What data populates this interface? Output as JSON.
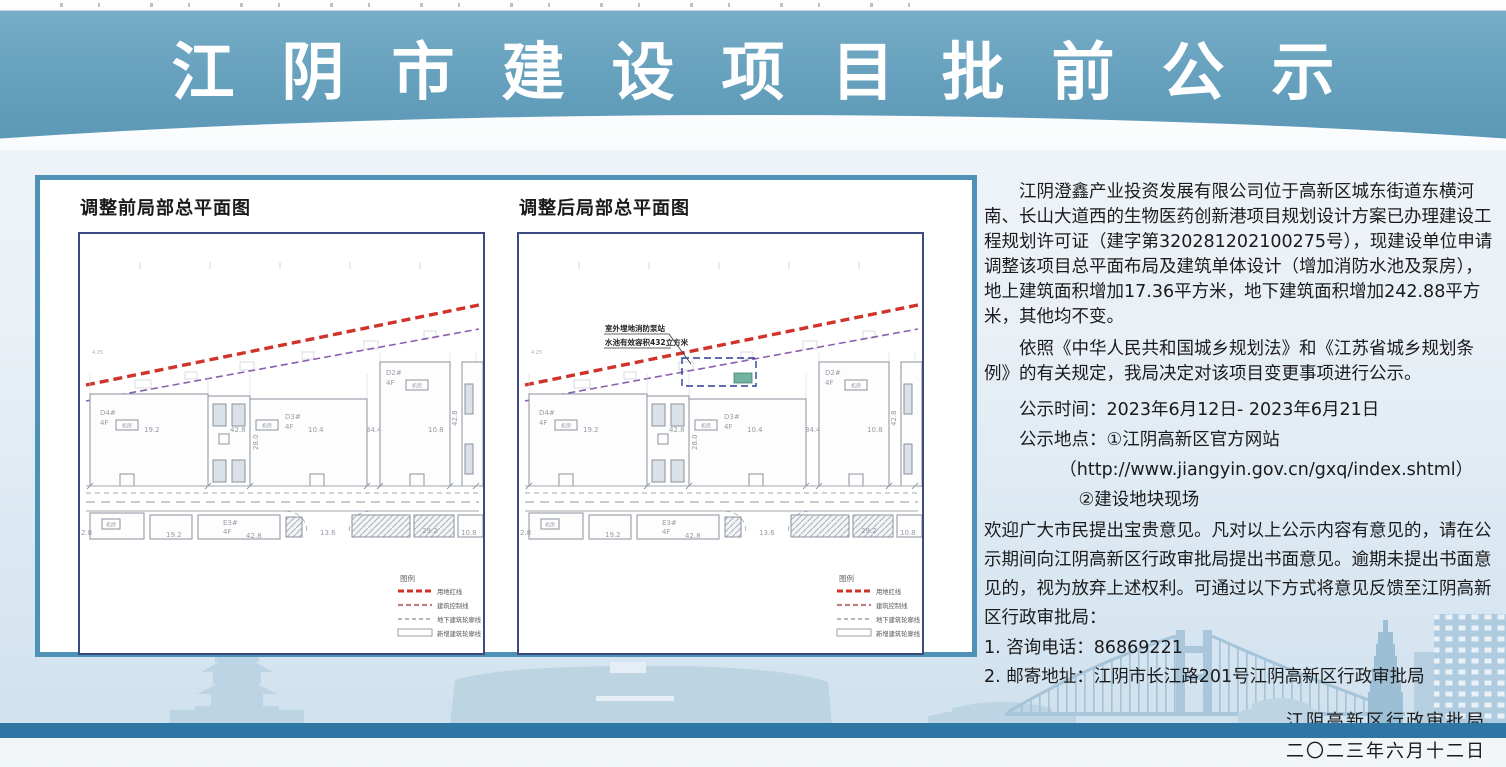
{
  "header": {
    "title": "江阴市建设项目批前公示"
  },
  "plans": {
    "before": {
      "title": "调整前局部总平面图"
    },
    "after": {
      "title": "调整后局部总平面图"
    }
  },
  "plan": {
    "misc_label": "4.25",
    "room_label": "机房",
    "buildings": {
      "d4": {
        "label": "D4#",
        "floors": "4F"
      },
      "d3": {
        "label": "D3#",
        "floors": "4F"
      },
      "d2": {
        "label": "D2#",
        "floors": "4F"
      },
      "e3": {
        "label": "E3#",
        "floors": "4F"
      }
    },
    "dims": {
      "w1": "19.2",
      "w2": "42.8",
      "w3": "10.4",
      "w4": "34.4",
      "w5": "10.8",
      "h1": "28.0",
      "h2": "42.8",
      "b1": "2.8",
      "b2": "19.2",
      "b3": "42.8",
      "b4": "13.6",
      "b5": "29.2",
      "b6": "10.8"
    },
    "legend": {
      "title": "图例",
      "items": [
        "用地红线",
        "建筑控制线",
        "地下建筑轮廓线",
        "新增建筑轮廓线"
      ]
    },
    "annotation": {
      "line1": "室外埋地消防泵站",
      "line2": "水池有效容积432立方米"
    }
  },
  "notice": {
    "p1": "江阴澄鑫产业投资发展有限公司位于高新区城东街道东横河南、长山大道西的生物医药创新港项目规划设计方案已办理建设工程规划许可证（建字第320281202100275号），现建设单位申请调整该项目总平面布局及建筑单体设计（增加消防水池及泵房），地上建筑面积增加17.36平方米，地下建筑面积增加242.88平方米，其他均不变。",
    "p2": "依照《中华人民共和国城乡规划法》和《江苏省城乡规划条例》的有关规定，我局决定对该项目变更事项进行公示。",
    "time_line": "公示时间：2023年6月12日- 2023年6月21日",
    "place_line": "公示地点：①江阴高新区官方网站",
    "url_line": "（http://www.jiangyin.gov.cn/gxq/index.shtml）",
    "place2_line": "②建设地块现场",
    "p3": "欢迎广大市民提出宝贵意见。凡对以上公示内容有意见的，请在公示期间向江阴高新区行政审批局提出书面意见。逾期未提出书面意见的，视为放弃上述权利。可通过以下方式将意见反馈至江阴高新区行政审批局：",
    "item1": "1. 咨询电话：86869221",
    "item2": "2. 邮寄地址：江阴市长江路201号江阴高新区行政审批局",
    "signature": "江阴高新区行政审批局",
    "date": "二〇二三年六月十二日"
  },
  "colors": {
    "header_bg": "#649fbc",
    "bottom_band": "#2e76a3",
    "panel_border": "#4e93b6",
    "red_line": "#cf332a",
    "control_line": "#8a5fae",
    "new_pump_box": "#72b2a0"
  }
}
